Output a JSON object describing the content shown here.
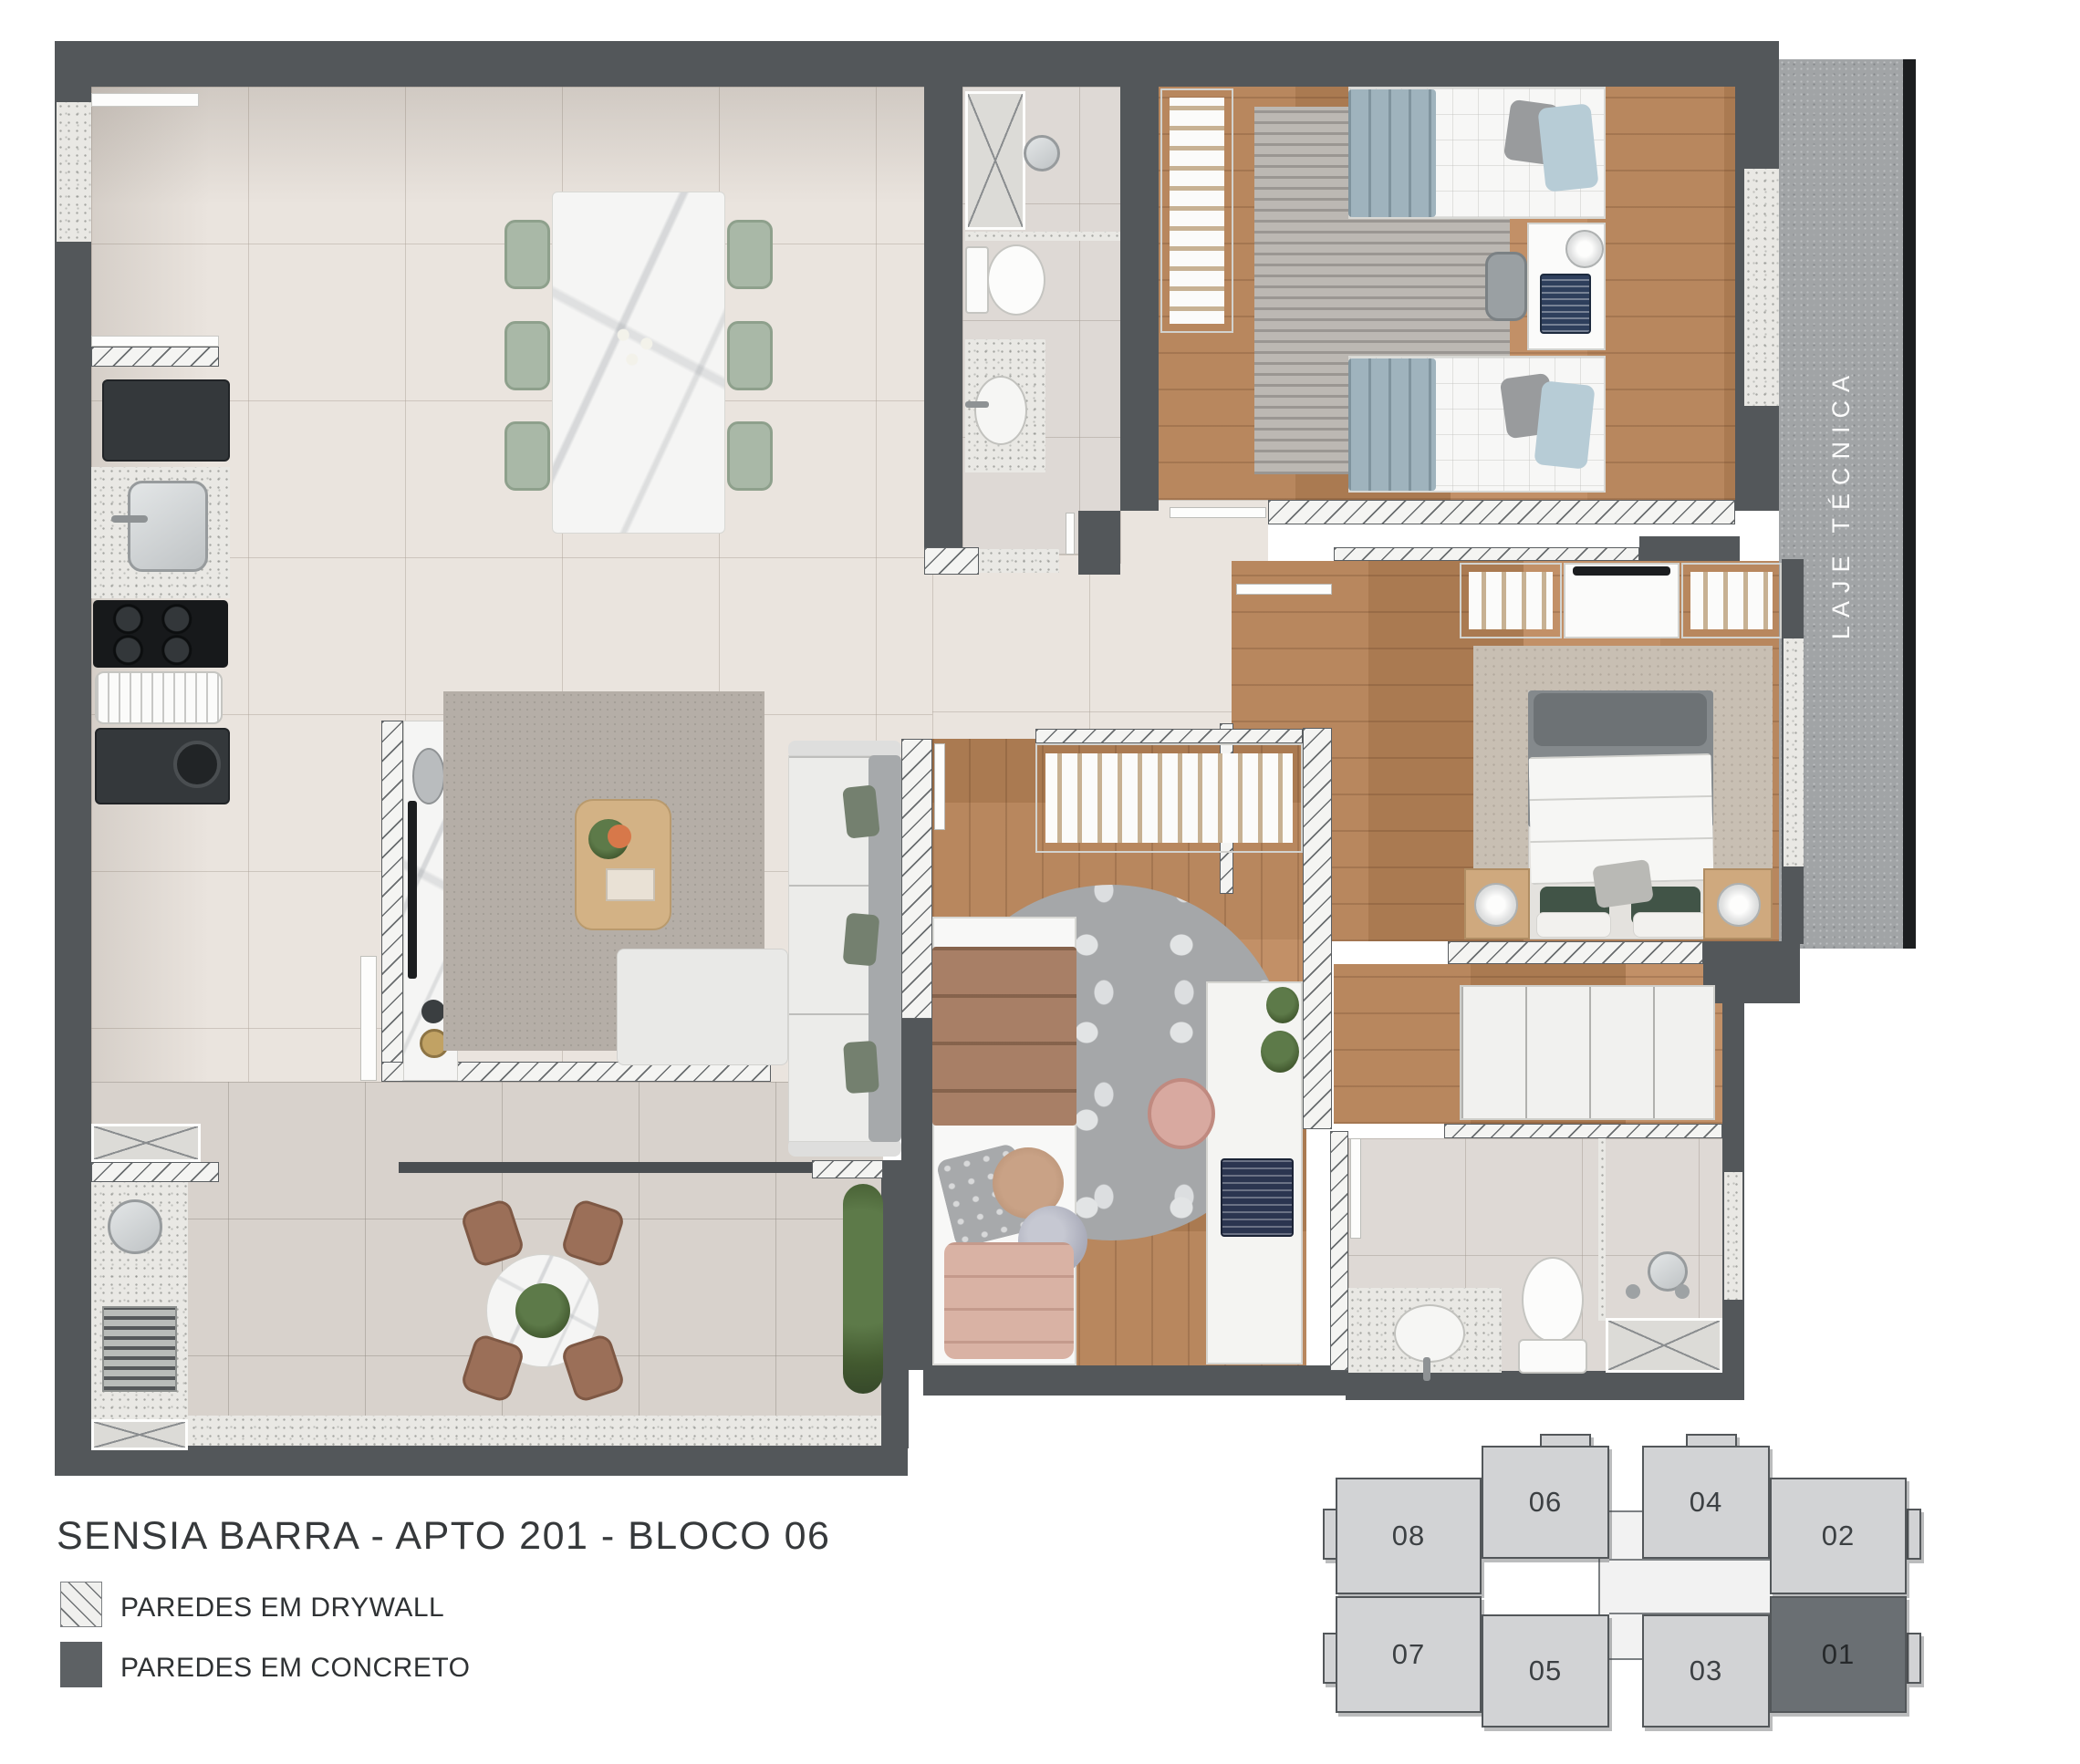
{
  "title": "SENSIA BARRA - APTO 201 - BLOCO 06",
  "legend": {
    "items": [
      {
        "label": "PAREDES EM DRYWALL",
        "swatch": "drywall-hatch"
      },
      {
        "label": "PAREDES EM CONCRETO",
        "swatch": "concrete-solid"
      }
    ]
  },
  "labels": {
    "laje_tecnica": "LAJE TÉCNICA"
  },
  "keyplan": {
    "units": [
      {
        "label": "08"
      },
      {
        "label": "06"
      },
      {
        "label": "04"
      },
      {
        "label": "02"
      },
      {
        "label": "07"
      },
      {
        "label": "05"
      },
      {
        "label": "03"
      },
      {
        "label": "01"
      }
    ],
    "highlighted_unit": "01"
  },
  "colors": {
    "concrete_wall": "#53575a",
    "drywall_fill": "#f4f4f2",
    "tile_floor": "#eae4de",
    "wood_floor": "#b5855c",
    "laje_fill": "#a1a4a6",
    "keyplan_unit": "#d2d3d5",
    "keyplan_highlight": "#6a6f73",
    "text": "#36393b"
  }
}
